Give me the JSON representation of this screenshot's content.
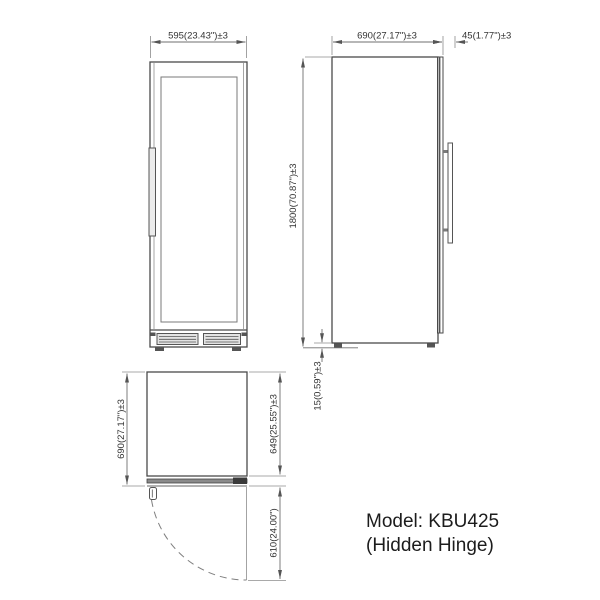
{
  "drawing": {
    "model": {
      "line1": "Model: KBU425",
      "line2": "(Hidden Hinge)"
    },
    "dims": {
      "front_width": "595(23.43\")±3",
      "height": "1800(70.87\")±3",
      "side_depth": "690(27.17\")±3",
      "door_thickness": "45(1.77\")±3",
      "foot_height": "15(0.59\")±3",
      "top_depth": "690(27.17\")±3",
      "body_depth": "649(25.55\")±3",
      "door_swing": "610(24.00\")"
    },
    "colors": {
      "line": "#4a4a4a",
      "dim_line": "#6f6f6f",
      "dim_text": "#333333",
      "model_text": "#1c1c1c",
      "background": "#ffffff"
    }
  }
}
